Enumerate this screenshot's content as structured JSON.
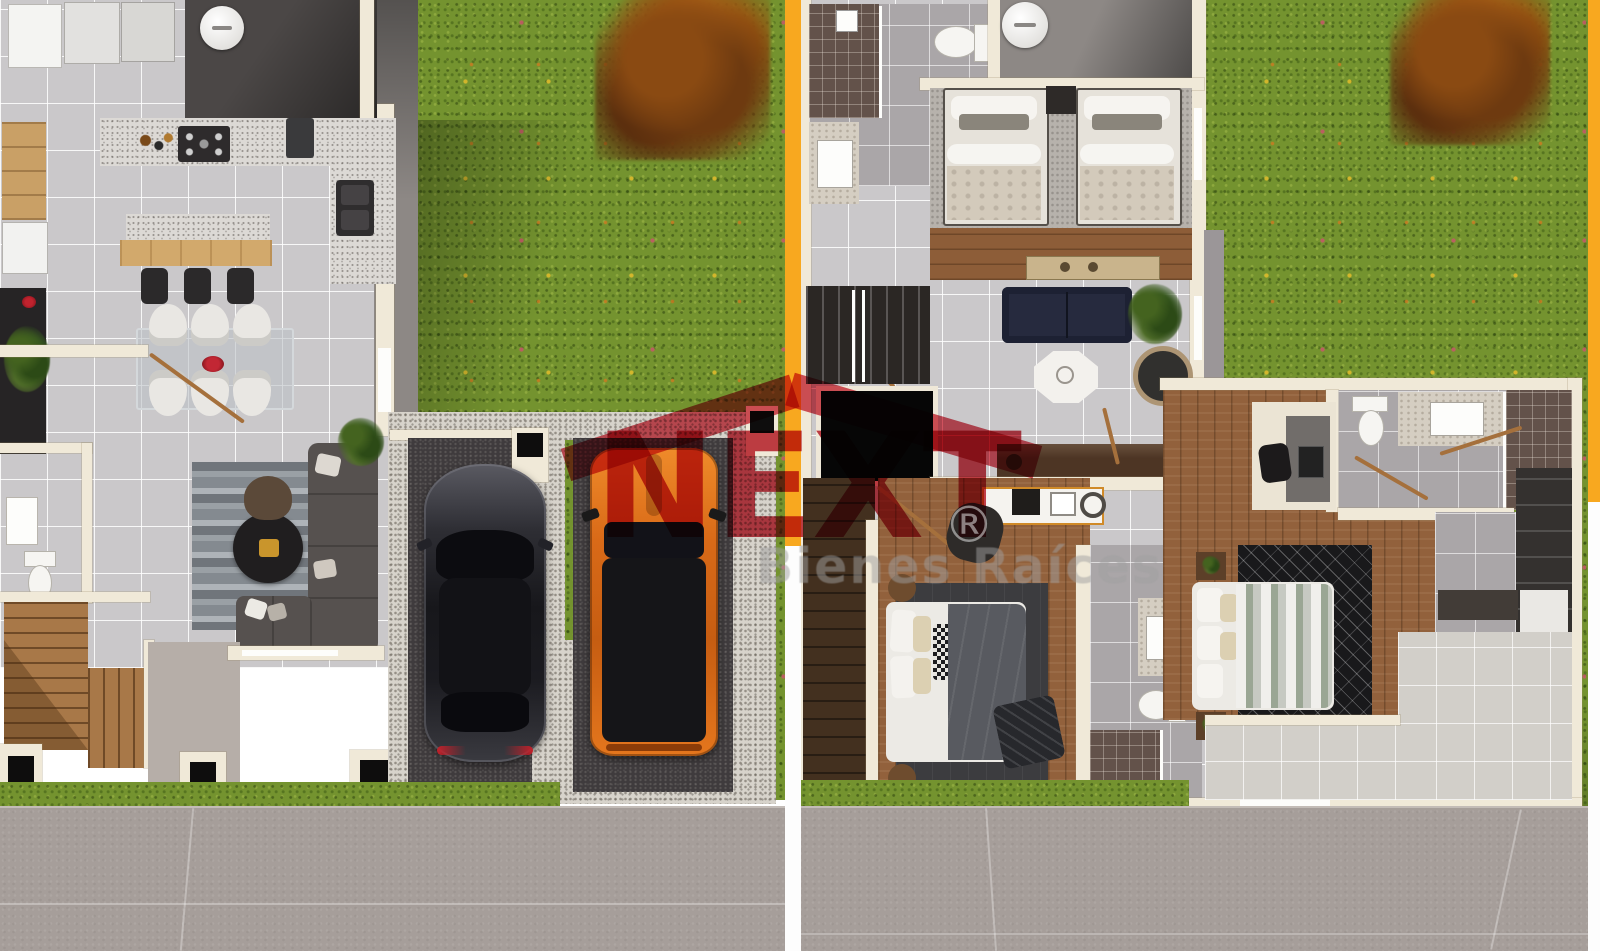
{
  "watermark": {
    "brand": "NEXT",
    "registered_mark": "®",
    "tagline": "Bienes Raíces",
    "brand_color": "#bf1f2e",
    "roof_color": "#cf2e3e"
  },
  "palette": {
    "grass": "#74932f",
    "divider_orange": "#f8a81f",
    "wall_cream": "#f0e9d8",
    "tile_gray": "#cac8ca",
    "garage_asphalt": "#3f3b3d",
    "gravel": "#d7d3cb",
    "wood_floor": "#92613c",
    "sidewalk_concrete": "#a69e9a",
    "sedan_color": "#26262b",
    "suv_color": "#dd6f1e"
  },
  "scene": {
    "type": "architectural-floor-plan-render",
    "panels": [
      {
        "id": "ground-floor-plan",
        "features": [
          "kitchen",
          "dining",
          "living-room",
          "powder-room",
          "stairs",
          "two-car-garage"
        ]
      },
      {
        "id": "upper-floor-plan",
        "features": [
          "twin-bedroom",
          "family-room",
          "two-bedrooms",
          "three-bathrooms",
          "walk-in-closet",
          "terrace"
        ]
      }
    ],
    "cars": [
      {
        "kind": "sedan",
        "color": "#26262b"
      },
      {
        "kind": "suv",
        "color": "#dd6f1e"
      }
    ]
  }
}
